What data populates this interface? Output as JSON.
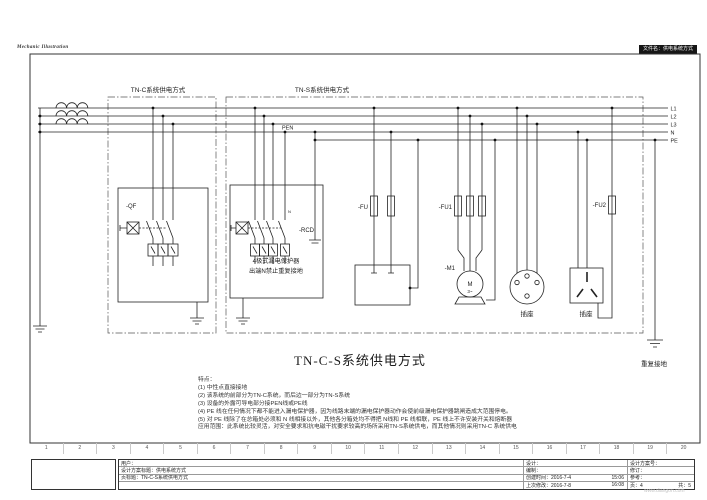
{
  "header": {
    "app_label": "Mechanic Illustration",
    "filename": "文件名：供电系统方式"
  },
  "sections": {
    "tnc": "TN-C系统供电方式",
    "tns": "TN-S系统供电方式"
  },
  "bus": {
    "labels": [
      "L1",
      "L2",
      "L3",
      "N",
      "PE"
    ],
    "pen": "PEN"
  },
  "components": {
    "qf": "-QF",
    "rcd": "-RCD",
    "rcd_n": "N",
    "rcd_line1": "4极式漏电保护器",
    "rcd_line2": "出端N禁止重复接地",
    "fu": "-FU",
    "fu1": "-FU1",
    "fu2": "-FU2",
    "m1": "-M1",
    "motor_m": "M",
    "motor_ph": "3~",
    "socket1": "插座",
    "socket2": "插座",
    "repeat_ground": "重复接地"
  },
  "title": "TN-C-S系统供电方式",
  "notes": [
    "特点：",
    "(1) 中性点直接接地",
    "(2) 该系统的前部分为TN-C系统，而后边一部分为TN-S系统",
    "(3) 设备的外露可导电部分接PEN线或PE线",
    "(4) PE 线在任何情况下都不能进入漏电保护器，因为线路末端的漏电保护器动作会使前级漏电保护器跳闸造成大范围停电。",
    "(5) 对 PE 线除了在总箱处必须和 N 线相接以外，其他各分箱处均不得把 N线和 PE 线相联，PE 线上不许安装开关和熔断器",
    "应用范围：此系统比较灵活，对安全要求和抗电磁干扰要求较高的场所采用TN-S系统供电，而其他情况则采用TN-C 系统供电"
  ],
  "ruler": [
    "1",
    "2",
    "3",
    "4",
    "5",
    "6",
    "7",
    "8",
    "9",
    "10",
    "11",
    "12",
    "13",
    "14",
    "15",
    "16",
    "17",
    "18",
    "19",
    "20"
  ],
  "titleblock": {
    "customer": "用户：",
    "project_title": "设计方案标题：供电系统方式",
    "page_title": "页标题：TN-C-S系统供电方式",
    "design": "设计：",
    "compile": "编制：",
    "created": "创建时间：2016-7-4",
    "created_time": "15:06",
    "modified": "上次修改：2016-7-8",
    "modified_time": "16:08",
    "scheme_no": "设计方案号：",
    "revision": "修订：",
    "reference": "参考：",
    "page": "页：4",
    "total": "共：5"
  },
  "watermark": "www.diangon.com"
}
